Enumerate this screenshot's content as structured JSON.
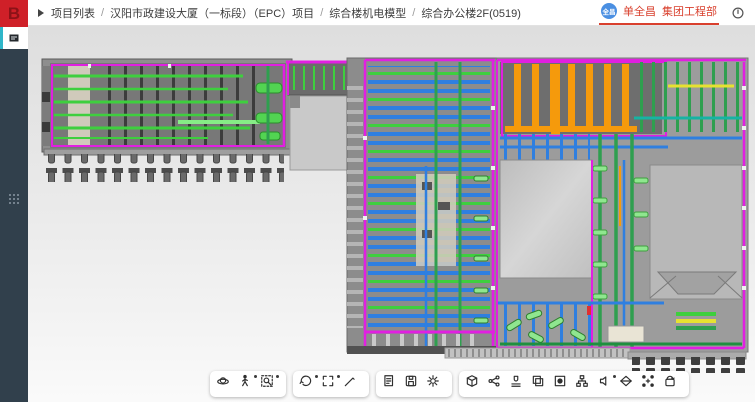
{
  "topbar": {
    "breadcrumb": [
      "项目列表",
      "汉阳市政建设大厦（一标段）（EPC）项目",
      "综合楼机电模型",
      "综合办公楼2F(0519)"
    ],
    "separator": "/",
    "user": {
      "avatar_text": "全昌",
      "name": "单全昌",
      "department": "集团工程部"
    }
  },
  "sidebar": {
    "logo_text": "B",
    "items": [
      {
        "name": "layers-panel",
        "active": true
      },
      {
        "name": "apps-grid",
        "active": false
      }
    ]
  },
  "canvas": {
    "palette": {
      "magenta": "#e11fe1",
      "green": "#3ecf3e",
      "green_dark": "#2f9f4f",
      "blue": "#2f7fe0",
      "orange": "#f59a0c",
      "yellow": "#e6e231",
      "teal": "#17b3a3",
      "accent_red": "#d9402e",
      "avatar_blue": "#4a8fe2",
      "sidebar_bg": "#31404c",
      "active_cyan": "#2fb6c9",
      "logo_red": "#cf2028"
    }
  },
  "toolbar": {
    "groups": [
      {
        "icons": [
          {
            "name": "orbit-3d"
          },
          {
            "name": "walk-mode",
            "dot": true
          },
          {
            "name": "zoom-window",
            "dot": true
          }
        ]
      },
      {
        "icons": [
          {
            "name": "view-rotate",
            "dot": true
          },
          {
            "name": "fit-view",
            "dot": true
          },
          {
            "name": "measure"
          }
        ]
      },
      {
        "icons": [
          {
            "name": "export-doc"
          },
          {
            "name": "save-view"
          },
          {
            "name": "settings"
          }
        ]
      },
      {
        "icons": [
          {
            "name": "model-box"
          },
          {
            "name": "share"
          },
          {
            "name": "stamp"
          },
          {
            "name": "copy"
          },
          {
            "name": "focus-target"
          },
          {
            "name": "structure-tree"
          },
          {
            "name": "audio-note",
            "dot": true
          },
          {
            "name": "flip-3d"
          },
          {
            "name": "scatter-select"
          },
          {
            "name": "reset-rotate"
          }
        ]
      }
    ]
  }
}
